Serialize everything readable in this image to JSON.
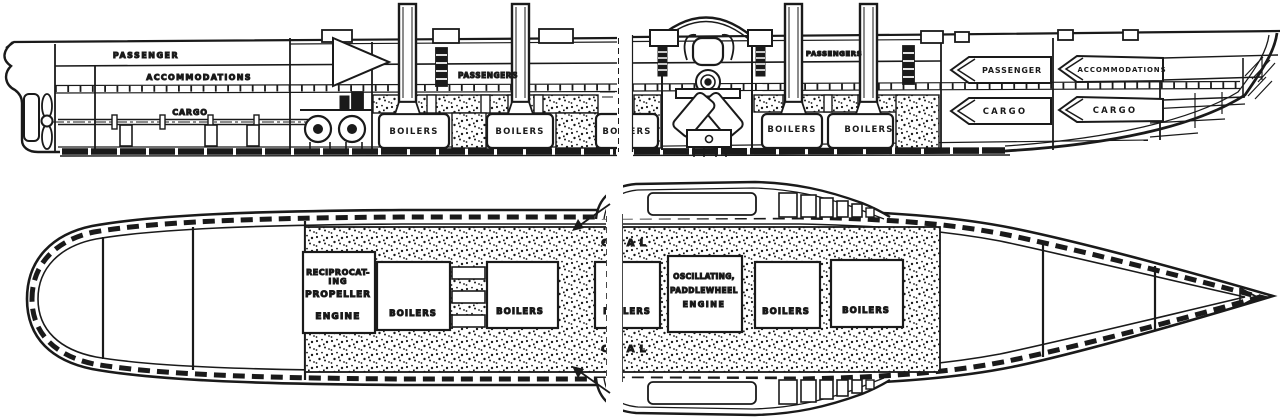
{
  "colors": {
    "ink": "#1a1a1a",
    "paper": "#ffffff"
  },
  "elevation": {
    "labels": {
      "passenger_aft": "PASSENGER",
      "accommodations_aft": "ACCOMMODATIONS",
      "cargo_aft": "CARGO",
      "passengers_mid": "PASSENGERS",
      "passengers_fwd": "PASSENGERS",
      "passenger_bow": "PASSENGER",
      "accommodations_bow": "ACCOMMODATIONS",
      "cargo_bow_aft": "CARGO",
      "cargo_bow_fwd": "CARGO",
      "boilers": [
        "BOILERS",
        "BOILERS",
        "BOILERS",
        "BOILERS",
        "BOILERS"
      ]
    }
  },
  "plan": {
    "labels": {
      "reciprocating_line1": "RECIPROCAT-",
      "reciprocating_line2": "ING",
      "reciprocating_line3": "PROPELLER",
      "reciprocating_line4": "ENGINE",
      "oscillating_line1": "OSCILLATING,",
      "oscillating_line2": "PADDLEWHEEL",
      "oscillating_line3": "ENGINE",
      "boilers": [
        "BOILERS",
        "BOILERS",
        "BOILERS",
        "BOILERS",
        "BOILERS"
      ],
      "coal_aft": "COAL",
      "coal_fwd": "COAL"
    }
  }
}
